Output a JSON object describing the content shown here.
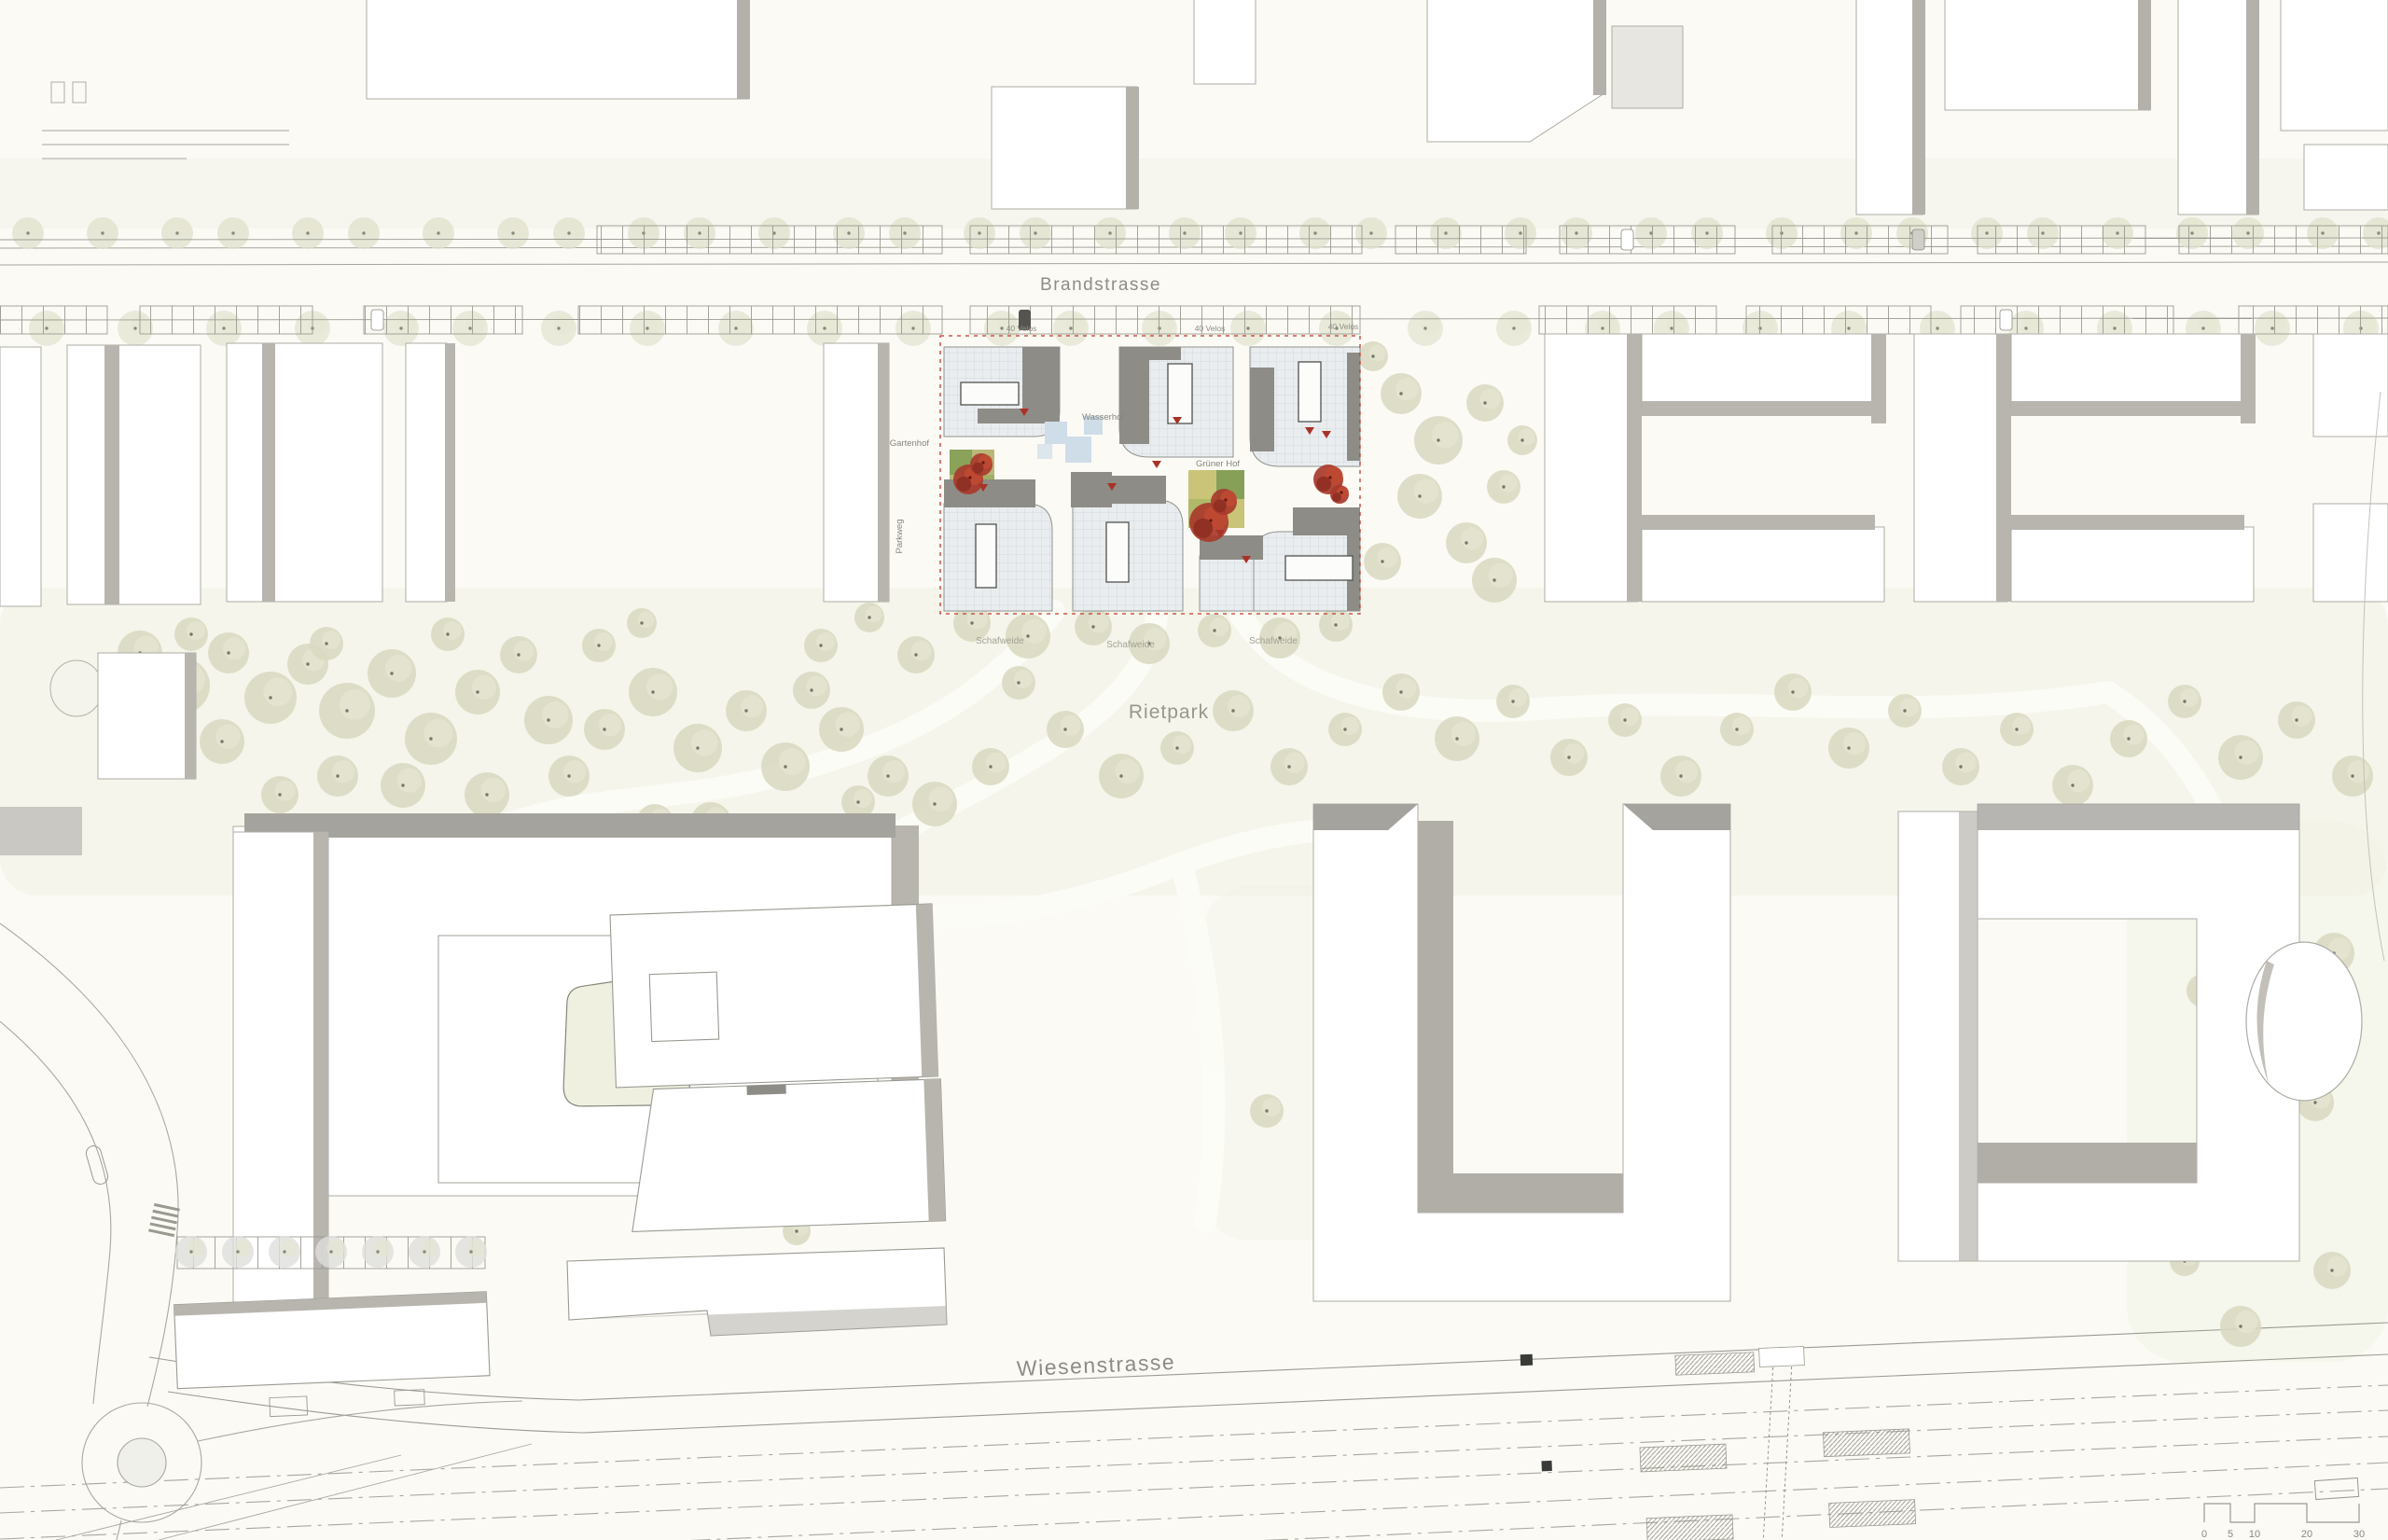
{
  "plan": {
    "labels": {
      "brandstrasse": "Brandstrasse",
      "wiesenstrasse": "Wiesenstrasse",
      "rietpark": "Rietpark",
      "parkweg": "Parkweg"
    },
    "courtyards": {
      "wasserhof": "Wasserhof",
      "gruener_hof": "Grüner Hof",
      "gartenhof": "Gartenhof"
    },
    "parking": {
      "velos_1": "40 Velos",
      "velos_2": "40 Velos",
      "velos_3": "40 Velos"
    },
    "meadows": {
      "m1": "Schafweide",
      "m2": "Schafweide",
      "m3": "Schafweide"
    },
    "scale_bar": {
      "tick_0": "0",
      "tick_5": "5",
      "tick_10": "10",
      "tick_20": "20",
      "tick_30": "30"
    },
    "colors": {
      "background": "#fbfaf5",
      "building_fill": "#ffffff",
      "building_outline": "#adaca4",
      "shadow_gray": "#b3b1aa",
      "roof_dark": "#8e8c86",
      "roof_light": "#e9edef",
      "accent_red": "#a93226",
      "site_boundary_red": "#c2392b",
      "tree_olive": "#d9d9c1",
      "lawn_green": "#f1f2e4",
      "courtyard_yellow": "#c9c477",
      "courtyard_green": "#7e9c53",
      "water_blue": "#cfdde8"
    }
  }
}
